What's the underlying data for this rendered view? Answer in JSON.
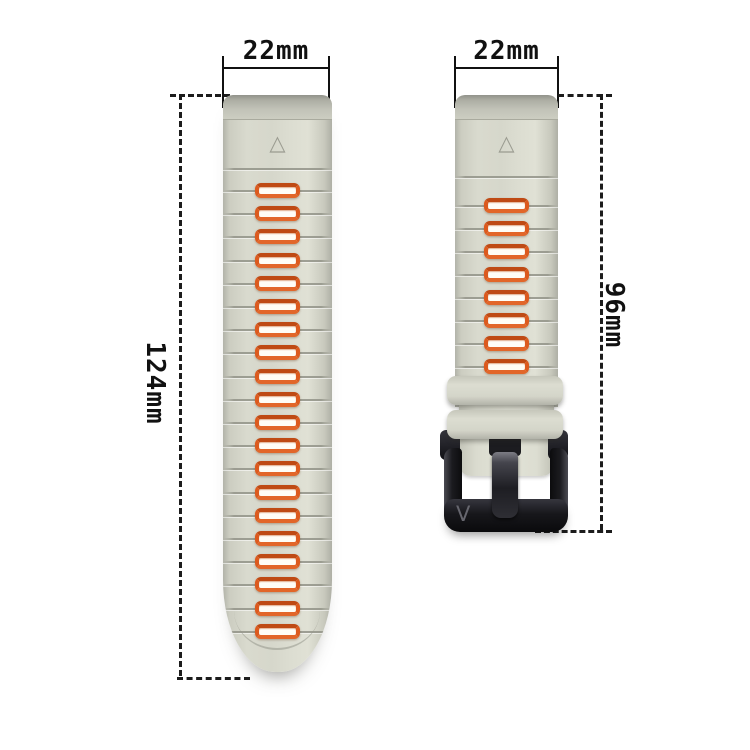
{
  "image_title": "watch band size diagram",
  "colors": {
    "background": "#ffffff",
    "strap": "#d6d7cb",
    "strap_edge": "#aeafa5",
    "hole_ring_orange": "#dc5a1e",
    "hole_fill": "#fffdf6",
    "groove": "#929388",
    "buckle_black": "#17171b",
    "dimension_ink": "#111111"
  },
  "dimensions": {
    "left_width": {
      "label": "22mm"
    },
    "right_width": {
      "label": "22mm"
    },
    "left_length": {
      "label": "124mm"
    },
    "right_length": {
      "label": "96mm"
    }
  },
  "left_strap": {
    "description": "long tail strap with pin holes",
    "hole_count": 20,
    "triangle_icon": "△"
  },
  "right_strap": {
    "description": "short buckle strap with keepers and black buckle",
    "hole_count": 10,
    "triangle_icon": "△",
    "keeper_count": 2
  },
  "buckle": {
    "logo": "V"
  }
}
